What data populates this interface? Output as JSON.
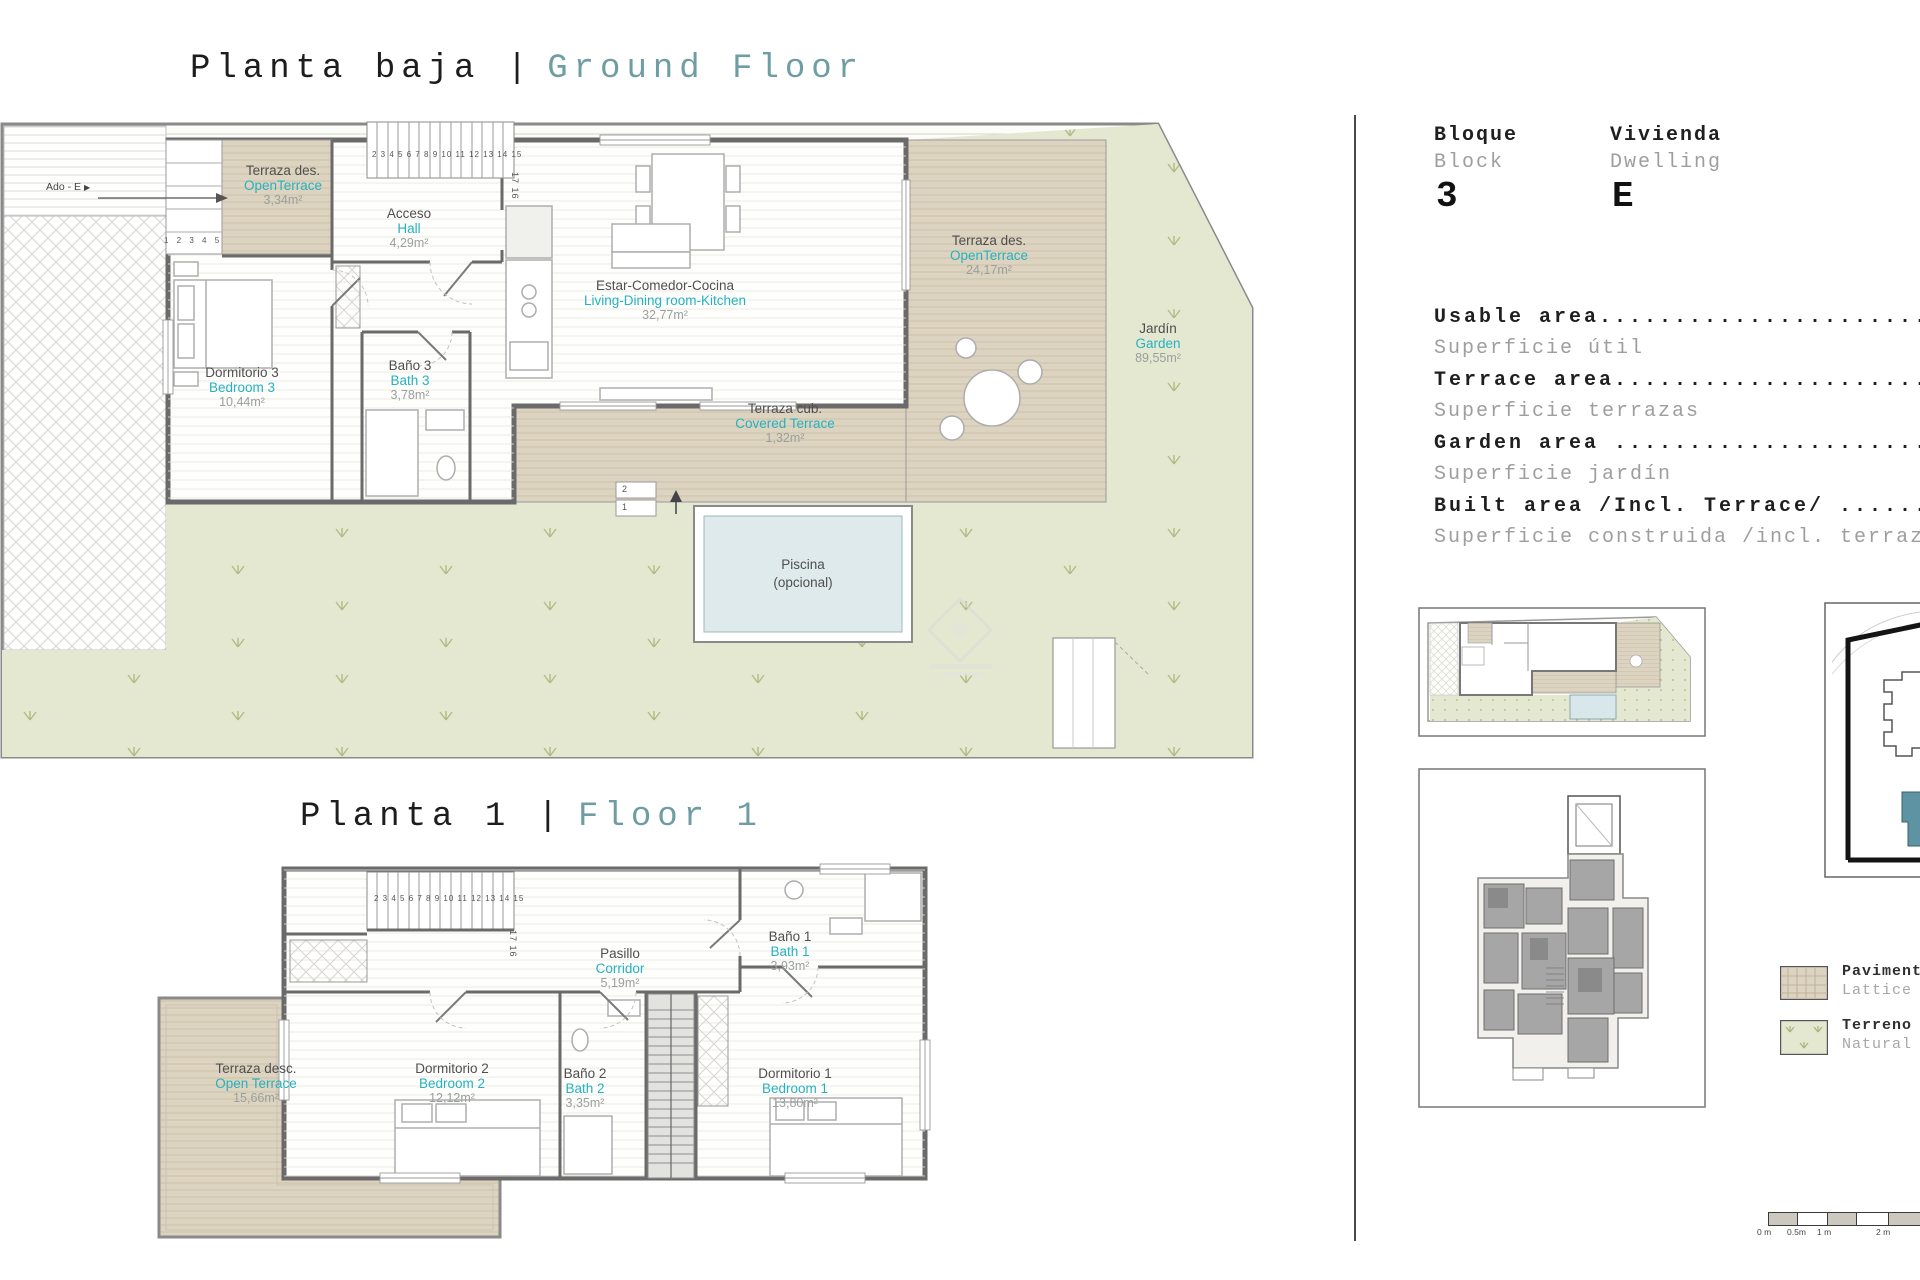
{
  "colors": {
    "title_teal": "#6f9da4",
    "label_teal": "#25b2c0",
    "label_gray": "#4f4f4f",
    "area_gray": "#9aa09d",
    "deck": "#ddd3c1",
    "garden": "#e4e8d1",
    "pool": "#dfeaec",
    "wall": "#6a6a6a",
    "site_teal": "#5d93a3",
    "ink": "#1f1f1f",
    "muted": "#9e9e9e"
  },
  "titles": {
    "ground_es": "Planta baja |",
    "ground_en": "Ground Floor",
    "floor1_es": "Planta 1 |",
    "floor1_en": "Floor 1"
  },
  "ground": {
    "neighbor": {
      "label": "Ado - E",
      "arrow": "▶"
    },
    "rooms": {
      "terrace_small": {
        "es": "Terraza des.",
        "en": "OpenTerrace",
        "area": "3,34m²"
      },
      "hall": {
        "es": "Acceso",
        "en": "Hall",
        "area": "4,29m²"
      },
      "living": {
        "es": "Estar-Comedor-Cocina",
        "en": "Living-Dining room-Kitchen",
        "area": "32,77m²"
      },
      "bedroom3": {
        "es": "Dormitorio 3",
        "en": "Bedroom 3",
        "area": "10,44m²"
      },
      "bath3": {
        "es": "Baño 3",
        "en": "Bath 3",
        "area": "3,78m²"
      },
      "terrace_right": {
        "es": "Terraza des.",
        "en": "OpenTerrace",
        "area": "24,17m²"
      },
      "garden": {
        "es": "Jardín",
        "en": "Garden",
        "area": "89,55m²"
      },
      "covered_terrace": {
        "es": "Terraza cub.",
        "en": "Covered Terrace",
        "area": "1,32m²"
      }
    },
    "pool": {
      "line1": "Piscina",
      "line2": "(opcional)"
    },
    "stairs": {
      "left": "1 2 3 4 5",
      "top": "2 3 4 5 6 7 8 9 10 11 12 13 14 15",
      "mid": "17 16",
      "pool_step_upper": "2",
      "pool_step_lower": "1"
    }
  },
  "floor1": {
    "rooms": {
      "terrace": {
        "es": "Terraza desc.",
        "en": "Open Terrace",
        "area": "15,66m²"
      },
      "corridor": {
        "es": "Pasillo",
        "en": "Corridor",
        "area": "5,19m²"
      },
      "bath1": {
        "es": "Baño 1",
        "en": "Bath 1",
        "area": "3,93m²"
      },
      "bedroom2": {
        "es": "Dormitorio 2",
        "en": "Bedroom 2",
        "area": "12,12m²"
      },
      "bath2": {
        "es": "Baño 2",
        "en": "Bath 2",
        "area": "3,35m²"
      },
      "bedroom1": {
        "es": "Dormitorio 1",
        "en": "Bedroom 1",
        "area": "13,80m²"
      }
    },
    "stairs": {
      "top": "2 3 4 5 6 7 8 9 10 11 12 13 14 15",
      "mid": "17 16"
    }
  },
  "panel": {
    "block": {
      "es": "Bloque",
      "en": "Block",
      "value": "3"
    },
    "dwelling": {
      "es": "Vivienda",
      "en": "Dwelling",
      "value": "E"
    },
    "areas": [
      {
        "en": "Usable area........................................",
        "es": "Superficie útil"
      },
      {
        "en": "Terrace area.......................................",
        "es": "Superficie terrazas"
      },
      {
        "en": "Garden area .......................................",
        "es": "Superficie jardín"
      },
      {
        "en": "Built area /Incl. Terrace/ ........................",
        "es": "Superficie construida /incl. terraza/"
      }
    ],
    "legend": [
      {
        "line1": "Pavimento",
        "line2": "Lattice"
      },
      {
        "line1": "Terreno",
        "line2": "Natural"
      }
    ],
    "scale_labels": [
      "0 m",
      "0.5m",
      "1 m",
      "2 m"
    ]
  }
}
